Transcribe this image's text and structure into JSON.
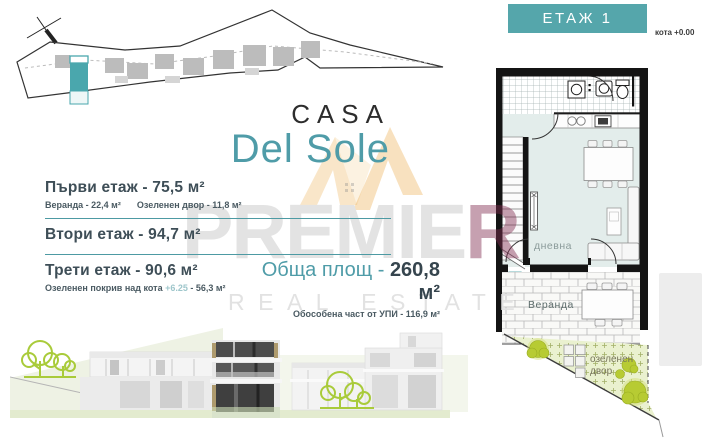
{
  "header": {
    "floor_label": "ЕТАЖ 1",
    "elevation_note": "кота +0.00"
  },
  "logo": {
    "line1": "CASA",
    "line2": "Del Sole"
  },
  "floors": [
    {
      "title": "Първи етаж - 75,5 м²",
      "detail1": "Веранда - 22,4 м²",
      "detail2": "Озеленен двор - 11,8 м²"
    },
    {
      "title": "Втори етаж - 94,7 м²"
    },
    {
      "title": "Трети етаж - 90,6 м²",
      "note_pre": "Озеленен покрив над кота ",
      "note_accent": "+6.25",
      "note_post": " - 56,3 м²"
    }
  ],
  "total": {
    "label": "Обща площ - ",
    "value": "260,8 м²",
    "note": "Обособена част от УПИ - 116,9 м²"
  },
  "watermark": {
    "brand_gray": "PREMIE",
    "brand_red": "R",
    "tagline": "REAL ESTATE"
  },
  "plan": {
    "living_room": "дневна",
    "veranda": "Веранда",
    "yard_line1": "озеленен",
    "yard_line2": "двор"
  },
  "colors": {
    "accent_teal": "#4f9ca8",
    "header_teal": "#55a6ab",
    "heading_text": "#3e4e57",
    "plan_room_fill": "#e3edeb",
    "yard_green": "#eaf1cf",
    "bush_green": "#b7cb33",
    "tree_outline": "#a9cb3a",
    "watermark_gray": "#e3e3e3",
    "watermark_red": "#802d4f",
    "logo_amber": "#eba53e",
    "site_unit_teal": "#4aa7ad"
  }
}
